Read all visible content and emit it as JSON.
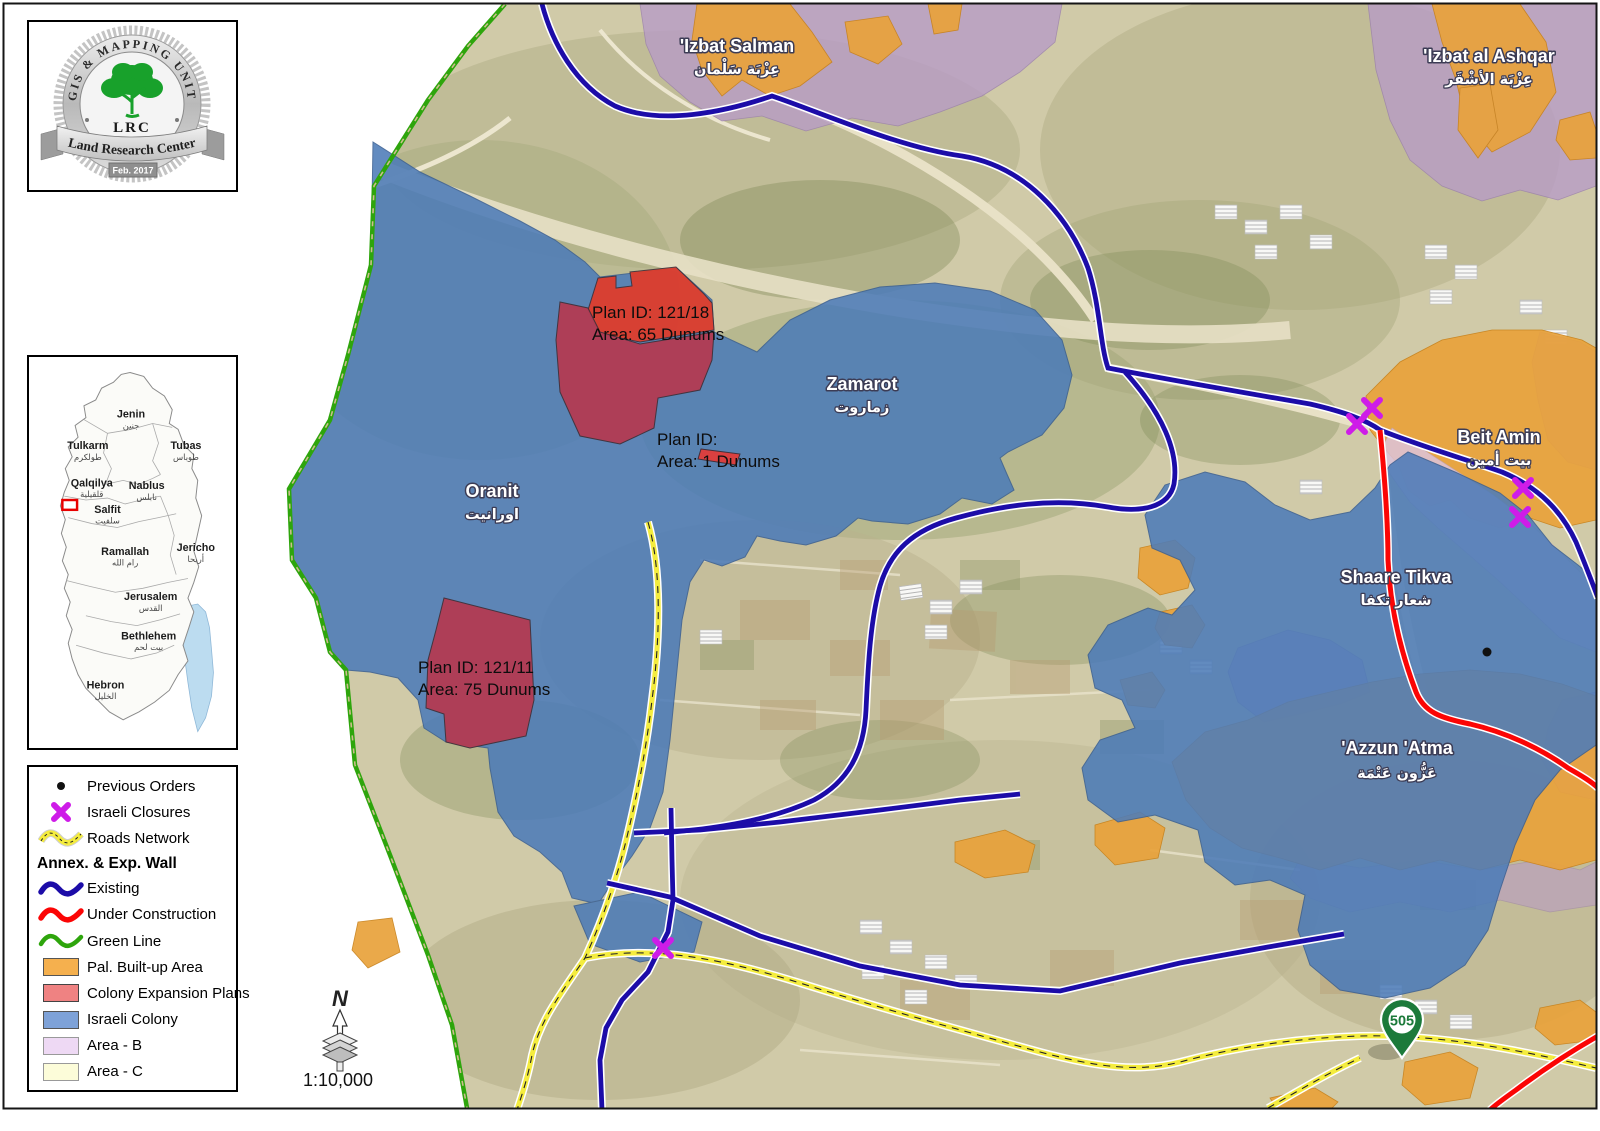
{
  "logo": {
    "arc_text": "GIS & MAPPING UNIT",
    "acronym": "LRC",
    "org_name": "Land Research Center",
    "date": "Feb. 2017"
  },
  "inset": {
    "regions": [
      {
        "en": "Jenin",
        "ar": "جنين"
      },
      {
        "en": "Tulkarm",
        "ar": "طولكرم"
      },
      {
        "en": "Tubas",
        "ar": "طوباس"
      },
      {
        "en": "Qalqilya",
        "ar": "قلقيلية"
      },
      {
        "en": "Nablus",
        "ar": "نابلس"
      },
      {
        "en": "Salfit",
        "ar": "سلفيت"
      },
      {
        "en": "Ramallah",
        "ar": "رام الله"
      },
      {
        "en": "Jericho",
        "ar": "أريحا"
      },
      {
        "en": "Jerusalem",
        "ar": "القدس"
      },
      {
        "en": "Bethlehem",
        "ar": "بيت لحم"
      },
      {
        "en": "Hebron",
        "ar": "الخليل"
      }
    ]
  },
  "legend": {
    "items": [
      {
        "label": "Previous Orders",
        "symbol": "dot"
      },
      {
        "label": "Israeli Closures",
        "symbol": "closure-x"
      },
      {
        "label": "Roads Network",
        "symbol": "road-line"
      },
      {
        "label": "Annex. & Exp. Wall",
        "symbol": "header"
      },
      {
        "label": "Existing",
        "symbol": "wall-existing"
      },
      {
        "label": "Under Construction",
        "symbol": "wall-under-construction"
      },
      {
        "label": "Green Line",
        "symbol": "green-line"
      },
      {
        "label": "Pal. Built-up Area",
        "symbol": "swatch-orange"
      },
      {
        "label": "Colony Expansion Plans",
        "symbol": "swatch-red"
      },
      {
        "label": "Israeli Colony",
        "symbol": "swatch-blue"
      },
      {
        "label": "Area - B",
        "symbol": "swatch-purple"
      },
      {
        "label": "Area - C",
        "symbol": "swatch-yellow"
      }
    ]
  },
  "scale_bar": {
    "north": "N",
    "scale": "1:10,000"
  },
  "map": {
    "places": [
      {
        "en": "'Izbat Salman",
        "ar": "عِزْبَة سَلْمان"
      },
      {
        "en": "'Izbat al Ashqar",
        "ar": "عِزْبَة الأشْقَر"
      },
      {
        "en": "Zamarot",
        "ar": "زماروت"
      },
      {
        "en": "Oranit",
        "ar": "اورانيت"
      },
      {
        "en": "Beit Amin",
        "ar": "بيت أمين"
      },
      {
        "en": "Shaare Tikva",
        "ar": "شعار تكفا"
      },
      {
        "en": "'Azzun 'Atma",
        "ar": "عَزُّون عَتْمَة"
      }
    ],
    "plans": [
      {
        "id_line": "Plan ID: 121/18",
        "area_line": "Area: 65 Dunums"
      },
      {
        "id_line": "Plan ID:",
        "area_line": "Area: 1 Dunums"
      },
      {
        "id_line": "Plan ID: 121/11",
        "area_line": "Area: 75 Dunums"
      }
    ],
    "road_shield": "505"
  },
  "colors": {
    "colony_blue": "#4d7bb8",
    "built_up_orange": "#e9a23b",
    "area_b_purple": "#b79bc6",
    "area_c_yellow": "#fcfcd9",
    "expansion_red": "#e23b28",
    "expansion_overlap": "#b23a52",
    "wall_existing": "#1c0ca8",
    "wall_under_construction": "#fb0505",
    "green_line": "#2ea50c",
    "road_yellow": "#f4ec3e",
    "closure_magenta": "#ce1ce8"
  }
}
